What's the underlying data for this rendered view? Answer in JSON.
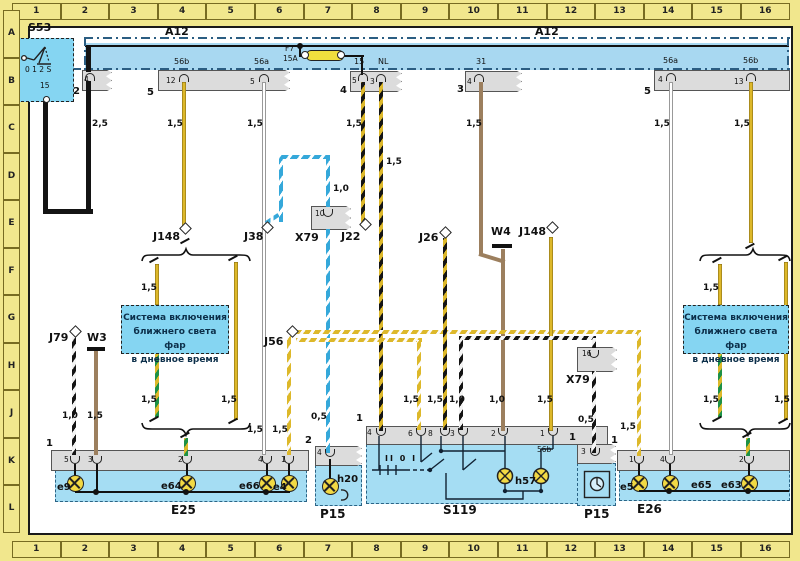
{
  "palette": {
    "page_yellow": "#f1e78d",
    "bus_blue": "#a8d8f1",
    "box_cyan": "#85d5f2",
    "block_blue": "#a5ddf3",
    "strip_gray": "#dcdcdc",
    "wire_yellow": "#ddb82a",
    "wire_brown": "#9c7f5e",
    "wire_blue": "#35a8da",
    "wire_green": "#1d9146",
    "lamp_yellow": "#f2d944"
  },
  "grid": {
    "columns": [
      "1",
      "2",
      "3",
      "4",
      "5",
      "6",
      "7",
      "8",
      "9",
      "10",
      "11",
      "12",
      "13",
      "14",
      "15",
      "16"
    ],
    "rows": [
      "A",
      "B",
      "C",
      "D",
      "E",
      "F",
      "G",
      "H",
      "J",
      "K",
      "L"
    ]
  },
  "note_box": {
    "lines": [
      "Система включения",
      "ближнего света фар",
      "в дневное время"
    ]
  },
  "labels": [
    {
      "n": "ref-s53",
      "t": "S53",
      "x": 28,
      "y": 22,
      "c": "ref"
    },
    {
      "n": "ref-a12-left",
      "t": "A12",
      "x": 165,
      "y": 26,
      "c": "ref"
    },
    {
      "n": "ref-a12-right",
      "t": "A12",
      "x": 535,
      "y": 26,
      "c": "ref"
    },
    {
      "n": "ref-f7",
      "t": "F7",
      "x": 285,
      "y": 45,
      "c": "pin"
    },
    {
      "n": "ref-f7-rating",
      "t": "15A",
      "x": 283,
      "y": 55,
      "c": "pin"
    },
    {
      "n": "s53-positions",
      "t": "0 1 2 S",
      "x": 25,
      "y": 66,
      "c": "pin"
    },
    {
      "n": "s53-terminal-15",
      "t": "15",
      "x": 40,
      "y": 82,
      "c": "pin"
    },
    {
      "n": "term-56b-left",
      "t": "56b",
      "x": 174,
      "y": 58,
      "c": "term"
    },
    {
      "n": "term-56a-left",
      "t": "56a",
      "x": 254,
      "y": 58,
      "c": "term"
    },
    {
      "n": "term-15",
      "t": "15",
      "x": 354,
      "y": 58,
      "c": "term"
    },
    {
      "n": "term-nl",
      "t": "NL",
      "x": 378,
      "y": 58,
      "c": "term"
    },
    {
      "n": "term-31",
      "t": "31",
      "x": 476,
      "y": 58,
      "c": "term"
    },
    {
      "n": "term-56a-right",
      "t": "56a",
      "x": 663,
      "y": 57,
      "c": "term"
    },
    {
      "n": "term-56b-right",
      "t": "56b",
      "x": 743,
      "y": 57,
      "c": "term"
    },
    {
      "n": "pin-a-4",
      "t": "4",
      "x": 84,
      "y": 76,
      "c": "pin"
    },
    {
      "n": "pin-b-12",
      "t": "12",
      "x": 166,
      "y": 77,
      "c": "pin"
    },
    {
      "n": "pin-b-5",
      "t": "5",
      "x": 250,
      "y": 78,
      "c": "pin"
    },
    {
      "n": "pin-c-5",
      "t": "5",
      "x": 352,
      "y": 77,
      "c": "pin"
    },
    {
      "n": "pin-c-3",
      "t": "3",
      "x": 370,
      "y": 78,
      "c": "pin"
    },
    {
      "n": "pin-d-4",
      "t": "4",
      "x": 467,
      "y": 78,
      "c": "pin"
    },
    {
      "n": "pin-e-4",
      "t": "4",
      "x": 658,
      "y": 76,
      "c": "pin"
    },
    {
      "n": "pin-e-13",
      "t": "13",
      "x": 734,
      "y": 78,
      "c": "pin"
    },
    {
      "n": "conn-s53",
      "t": "2",
      "x": 73,
      "y": 87,
      "c": "ext"
    },
    {
      "n": "conn-b",
      "t": "5",
      "x": 147,
      "y": 88,
      "c": "ext"
    },
    {
      "n": "conn-c",
      "t": "4",
      "x": 340,
      "y": 86,
      "c": "ext"
    },
    {
      "n": "conn-d",
      "t": "3",
      "x": 457,
      "y": 85,
      "c": "ext"
    },
    {
      "n": "conn-e",
      "t": "5",
      "x": 644,
      "y": 87,
      "c": "ext"
    },
    {
      "n": "gauge-black",
      "t": "2,5",
      "x": 92,
      "y": 120,
      "c": "g"
    },
    {
      "n": "gauge-56b-left",
      "t": "1,5",
      "x": 167,
      "y": 120,
      "c": "g"
    },
    {
      "n": "gauge-56a-left",
      "t": "1,5",
      "x": 247,
      "y": 120,
      "c": "g"
    },
    {
      "n": "gauge-15",
      "t": "1,5",
      "x": 346,
      "y": 120,
      "c": "g"
    },
    {
      "n": "gauge-nl",
      "t": "1,5",
      "x": 386,
      "y": 158,
      "c": "g"
    },
    {
      "n": "gauge-31",
      "t": "1,5",
      "x": 466,
      "y": 120,
      "c": "g"
    },
    {
      "n": "gauge-56a-right",
      "t": "1,5",
      "x": 654,
      "y": 120,
      "c": "g"
    },
    {
      "n": "gauge-56b-right",
      "t": "1,5",
      "x": 734,
      "y": 120,
      "c": "g"
    },
    {
      "n": "gauge-x79-10",
      "t": "1,0",
      "x": 333,
      "y": 185,
      "c": "g"
    },
    {
      "n": "ref-j148-left",
      "t": "J148",
      "x": 153,
      "y": 231,
      "c": "ref"
    },
    {
      "n": "ref-j38",
      "t": "J38",
      "x": 244,
      "y": 231,
      "c": "ref"
    },
    {
      "n": "ref-x79-left",
      "t": "X79",
      "x": 295,
      "y": 232,
      "c": "ref"
    },
    {
      "n": "pin-x79-10",
      "t": "10",
      "x": 315,
      "y": 210,
      "c": "pin"
    },
    {
      "n": "ref-j22",
      "t": "J22",
      "x": 341,
      "y": 231,
      "c": "ref"
    },
    {
      "n": "ref-j26",
      "t": "J26",
      "x": 419,
      "y": 232,
      "c": "ref"
    },
    {
      "n": "ref-w4",
      "t": "W4",
      "x": 491,
      "y": 226,
      "c": "ref"
    },
    {
      "n": "ref-j148-right",
      "t": "J148",
      "x": 519,
      "y": 226,
      "c": "ref"
    },
    {
      "n": "gauge-branch-l1-top",
      "t": "1,5",
      "x": 141,
      "y": 284,
      "c": "g"
    },
    {
      "n": "gauge-branch-r1-top",
      "t": "1,5",
      "x": 703,
      "y": 284,
      "c": "g"
    },
    {
      "n": "ref-j79",
      "t": "J79",
      "x": 49,
      "y": 332,
      "c": "ref"
    },
    {
      "n": "ref-w3",
      "t": "W3",
      "x": 87,
      "y": 332,
      "c": "ref"
    },
    {
      "n": "ref-j56",
      "t": "J56",
      "x": 264,
      "y": 336,
      "c": "ref"
    },
    {
      "n": "ref-x79-right",
      "t": "X79",
      "x": 566,
      "y": 374,
      "c": "ref"
    },
    {
      "n": "pin-x79-16",
      "t": "16",
      "x": 582,
      "y": 350,
      "c": "pin"
    },
    {
      "n": "gauge-j79",
      "t": "1,0",
      "x": 62,
      "y": 412,
      "c": "g"
    },
    {
      "n": "gauge-w3",
      "t": "1,5",
      "x": 87,
      "y": 412,
      "c": "g"
    },
    {
      "n": "gauge-branch-l1-bot",
      "t": "1,5",
      "x": 141,
      "y": 396,
      "c": "g"
    },
    {
      "n": "gauge-branch-l2-bot",
      "t": "1,5",
      "x": 221,
      "y": 396,
      "c": "g"
    },
    {
      "n": "gauge-e25-4",
      "t": "1,5",
      "x": 247,
      "y": 426,
      "c": "g"
    },
    {
      "n": "gauge-e25-1",
      "t": "1,5",
      "x": 272,
      "y": 426,
      "c": "g"
    },
    {
      "n": "gauge-p15l",
      "t": "0,5",
      "x": 311,
      "y": 413,
      "c": "g"
    },
    {
      "n": "gauge-s119-6",
      "t": "1,5",
      "x": 403,
      "y": 396,
      "c": "g"
    },
    {
      "n": "gauge-s119-8",
      "t": "1,5",
      "x": 427,
      "y": 396,
      "c": "g"
    },
    {
      "n": "gauge-s119-3",
      "t": "1,0",
      "x": 449,
      "y": 396,
      "c": "g"
    },
    {
      "n": "gauge-s119-2",
      "t": "1,0",
      "x": 489,
      "y": 396,
      "c": "g"
    },
    {
      "n": "gauge-s119-1",
      "t": "1,5",
      "x": 537,
      "y": 396,
      "c": "g"
    },
    {
      "n": "gauge-p15r",
      "t": "0,5",
      "x": 578,
      "y": 416,
      "c": "g"
    },
    {
      "n": "gauge-e26-1",
      "t": "1,5",
      "x": 620,
      "y": 423,
      "c": "g"
    },
    {
      "n": "gauge-branch-r1-bot",
      "t": "1,5",
      "x": 703,
      "y": 396,
      "c": "g"
    },
    {
      "n": "gauge-branch-r2-bot",
      "t": "1,5",
      "x": 774,
      "y": 396,
      "c": "g"
    },
    {
      "n": "corner-e25",
      "t": "1",
      "x": 46,
      "y": 439,
      "c": "ext"
    },
    {
      "n": "corner-p15l",
      "t": "2",
      "x": 305,
      "y": 436,
      "c": "ext"
    },
    {
      "n": "corner-s119",
      "t": "1",
      "x": 356,
      "y": 414,
      "c": "ext"
    },
    {
      "n": "corner-p15r",
      "t": "1",
      "x": 569,
      "y": 433,
      "c": "ext"
    },
    {
      "n": "corner-e26",
      "t": "1",
      "x": 611,
      "y": 436,
      "c": "ext"
    },
    {
      "n": "pin-e25-5",
      "t": "5",
      "x": 64,
      "y": 456,
      "c": "pin"
    },
    {
      "n": "pin-e25-3",
      "t": "3",
      "x": 88,
      "y": 456,
      "c": "pin"
    },
    {
      "n": "pin-e25-2",
      "t": "2",
      "x": 178,
      "y": 456,
      "c": "pin"
    },
    {
      "n": "pin-e25-4",
      "t": "4",
      "x": 258,
      "y": 456,
      "c": "pin"
    },
    {
      "n": "pin-e25-1",
      "t": "1",
      "x": 281,
      "y": 456,
      "c": "pin"
    },
    {
      "n": "pin-p15l-4",
      "t": "4",
      "x": 317,
      "y": 449,
      "c": "pin"
    },
    {
      "n": "pin-s119-4",
      "t": "4",
      "x": 367,
      "y": 429,
      "c": "pin"
    },
    {
      "n": "pin-s119-6",
      "t": "6",
      "x": 408,
      "y": 430,
      "c": "pin"
    },
    {
      "n": "pin-s119-8",
      "t": "8",
      "x": 428,
      "y": 430,
      "c": "pin"
    },
    {
      "n": "pin-s119-3",
      "t": "3",
      "x": 450,
      "y": 430,
      "c": "pin"
    },
    {
      "n": "pin-s119-2",
      "t": "2",
      "x": 491,
      "y": 430,
      "c": "pin"
    },
    {
      "n": "pin-s119-1",
      "t": "1",
      "x": 540,
      "y": 430,
      "c": "pin"
    },
    {
      "n": "s119-term-56b",
      "t": "56b",
      "x": 537,
      "y": 446,
      "c": "pin"
    },
    {
      "n": "s119-switch-positions",
      "t": "II 0 I",
      "x": 385,
      "y": 455,
      "c": "sw8"
    },
    {
      "n": "pin-p15r-3",
      "t": "3",
      "x": 581,
      "y": 448,
      "c": "pin"
    },
    {
      "n": "pin-e26-1",
      "t": "1",
      "x": 629,
      "y": 456,
      "c": "pin"
    },
    {
      "n": "pin-e26-4",
      "t": "4",
      "x": 660,
      "y": 456,
      "c": "pin"
    },
    {
      "n": "pin-e26-2",
      "t": "2",
      "x": 739,
      "y": 456,
      "c": "pin"
    },
    {
      "n": "lamp-e9",
      "t": "e9",
      "x": 57,
      "y": 483,
      "c": "lmp"
    },
    {
      "n": "lamp-e64",
      "t": "e64",
      "x": 161,
      "y": 482,
      "c": "lmp"
    },
    {
      "n": "lamp-e66",
      "t": "e66",
      "x": 239,
      "y": 482,
      "c": "lmp"
    },
    {
      "n": "lamp-e4",
      "t": "e4",
      "x": 273,
      "y": 483,
      "c": "lmp"
    },
    {
      "n": "lamp-h20",
      "t": "h20",
      "x": 337,
      "y": 475,
      "c": "lmp"
    },
    {
      "n": "lamp-h57",
      "t": "h57",
      "x": 515,
      "y": 477,
      "c": "lmp"
    },
    {
      "n": "lamp-e5",
      "t": "e5",
      "x": 620,
      "y": 483,
      "c": "lmp"
    },
    {
      "n": "lamp-e65",
      "t": "e65",
      "x": 691,
      "y": 481,
      "c": "lmp"
    },
    {
      "n": "lamp-e63",
      "t": "e63",
      "x": 721,
      "y": 481,
      "c": "lmp"
    },
    {
      "n": "block-e25",
      "t": "E25",
      "x": 171,
      "y": 504,
      "c": "blk"
    },
    {
      "n": "block-p15-left",
      "t": "P15",
      "x": 320,
      "y": 508,
      "c": "blk"
    },
    {
      "n": "block-s119",
      "t": "S119",
      "x": 443,
      "y": 504,
      "c": "blk"
    },
    {
      "n": "block-p15-right",
      "t": "P15",
      "x": 584,
      "y": 508,
      "c": "blk"
    },
    {
      "n": "block-e26",
      "t": "E26",
      "x": 637,
      "y": 503,
      "c": "blk"
    }
  ]
}
